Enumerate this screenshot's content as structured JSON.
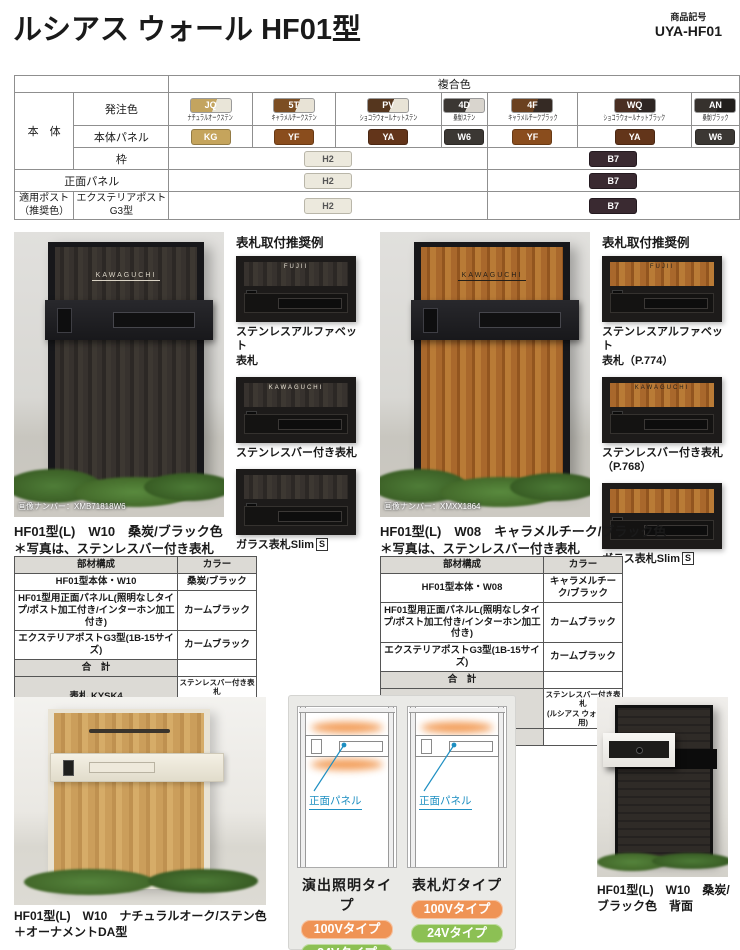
{
  "header": {
    "title": "ルシアス ウォール HF01型",
    "code_label": "商品記号",
    "code": "UYA-HF01"
  },
  "feature_badges": {
    "b1": "左右あり",
    "b2": "照明"
  },
  "color_table": {
    "composite_header": "複合色",
    "body_label": "本　体",
    "order_label": "発注色",
    "panel_label": "本体パネル",
    "frame_label": "枠",
    "front_panel_label": "正面パネル",
    "post_label_1": "適用ポスト",
    "post_label_2": "（推奨色）",
    "post_name_1": "エクステリアポスト",
    "post_name_2": "G3型",
    "order_colors": [
      {
        "code": "JQ",
        "name": "ナチュラルオークステン",
        "bg": "linear-gradient(112deg,#c3a45f 58%,#e9e5d8 58%)"
      },
      {
        "code": "5T",
        "name": "キャラメルチークステン",
        "bg": "linear-gradient(112deg,#7c4e23 58%,#e8e3d6 58%)"
      },
      {
        "code": "PV",
        "name": "ショコラウォールナットステン",
        "bg": "linear-gradient(112deg,#55361e 58%,#e8e3d6 58%)"
      },
      {
        "code": "4D",
        "name": "桑炭/ステン",
        "bg": "linear-gradient(112deg,#3b3733 58%,#d9d5ce 58%)"
      },
      {
        "code": "4F",
        "name": "キャラメルチークブラック",
        "bg": "linear-gradient(112deg,#6b4120 58%,#352a24 58%)"
      },
      {
        "code": "WQ",
        "name": "ショコラウォールナットブラック",
        "bg": "linear-gradient(112deg,#4a2f23 58%,#2e2623 58%)"
      },
      {
        "code": "AN",
        "name": "桑炭/ブラック",
        "bg": "linear-gradient(112deg,#36312d 58%,#211e1c 58%)"
      }
    ],
    "panel_colors": [
      {
        "code": "KG",
        "bg": "#c5a45c"
      },
      {
        "code": "YF",
        "bg": "#8a4d1d"
      },
      {
        "code": "YA",
        "bg": "#63351a"
      },
      {
        "code": "W6",
        "bg": "#3b3733"
      },
      {
        "code": "YF",
        "bg": "#8a4d1d"
      },
      {
        "code": "YA",
        "bg": "#63351a"
      },
      {
        "code": "W6",
        "bg": "#3b3733"
      }
    ],
    "frame_sten": {
      "code": "H2",
      "bg": "#ece9dd"
    },
    "frame_black": {
      "code": "B7",
      "bg": "#3a2a31"
    }
  },
  "left_section": {
    "recommend_title": "表札取付推奨例",
    "cap1a": "ステンレスアルファベット",
    "cap1b": "表札",
    "cap2": "ステンレスバー付き表札",
    "cap3": "ガラス表札Slim",
    "cap3_s": "S",
    "image_number": "画像ナンバー：XMB71818W6",
    "nameplate": "KAWAGUCHI",
    "thumb_name1": "FUJII",
    "thumb_name2": "KAWAGUCHI",
    "caption1": "HF01型(L)　W10　桑炭/ブラック色",
    "caption2": "＊写真は、ステンレスバー付き表札",
    "table": {
      "h1": "部材構成",
      "h2": "カラー",
      "rows": [
        {
          "part": "HF01型本体・W10",
          "color": "桑炭/ブラック"
        },
        {
          "part": "HF01型用正面パネルL(照明なしタイプ/ポスト加工付き/インターホン加工付き)",
          "color": "カームブラック"
        },
        {
          "part": "エクステリアポストG3型(1B-15サイズ)",
          "color": "カームブラック"
        },
        {
          "part": "合　計",
          "color": ""
        },
        {
          "part": "表札 KYSK4",
          "color_1": "ステンレスバー付き表札",
          "color_2": "(ルシアス ウォール専用)"
        },
        {
          "part": "表札込み価格",
          "color": ""
        }
      ]
    },
    "footer": "XUYA001A"
  },
  "right_section": {
    "recommend_title": "表札取付推奨例",
    "cap1a": "ステンレスアルファベット",
    "cap1b": "表札（P.774）",
    "cap2a": "ステンレスバー付き表札",
    "cap2b": "（P.768）",
    "cap3": "ガラス表札Slim",
    "cap3_s": "S",
    "image_number": "画像ナンバー：XMXX1864",
    "nameplate": "KAWAGUCHI",
    "thumb_name1": "FUJII",
    "thumb_name2": "KAWAGUCHI",
    "caption1": "HF01型(L)　W08　キャラメルチーク/ブラック色",
    "caption2": "＊写真は、ステンレスバー付き表札",
    "table": {
      "h1": "部材構成",
      "h2": "カラー",
      "rows": [
        {
          "part": "HF01型本体・W08",
          "color": "キャラメルチーク/ブラック"
        },
        {
          "part": "HF01型用正面パネルL(照明なしタイプ/ポスト加工付き/インターホン加工付き)",
          "color": "カームブラック"
        },
        {
          "part": "エクステリアポストG3型(1B-15サイズ)",
          "color": "カームブラック"
        },
        {
          "part": "合　計",
          "color": ""
        },
        {
          "part": "表札 KYSK4",
          "color_1": "ステンレスバー付き表札",
          "color_2": "(ルシアス ウォール専用)"
        },
        {
          "part": "表札込み価格",
          "color": ""
        }
      ]
    },
    "footer": "XUYA001B"
  },
  "bottom": {
    "left_caption1": "HF01型(L)　W10　ナチュラルオーク/ステン色",
    "left_caption2": "＋オーナメントDA型",
    "right_caption": "HF01型(L)　W10　桑炭/ブラック色　背面",
    "diagrams": {
      "panel_label": "正面パネル",
      "type1": "演出照明タイプ",
      "type2": "表札灯タイプ",
      "v100": "100Vタイプ",
      "v24": "24Vタイプ",
      "orange": "#ef9355",
      "green": "#8cc054"
    }
  }
}
